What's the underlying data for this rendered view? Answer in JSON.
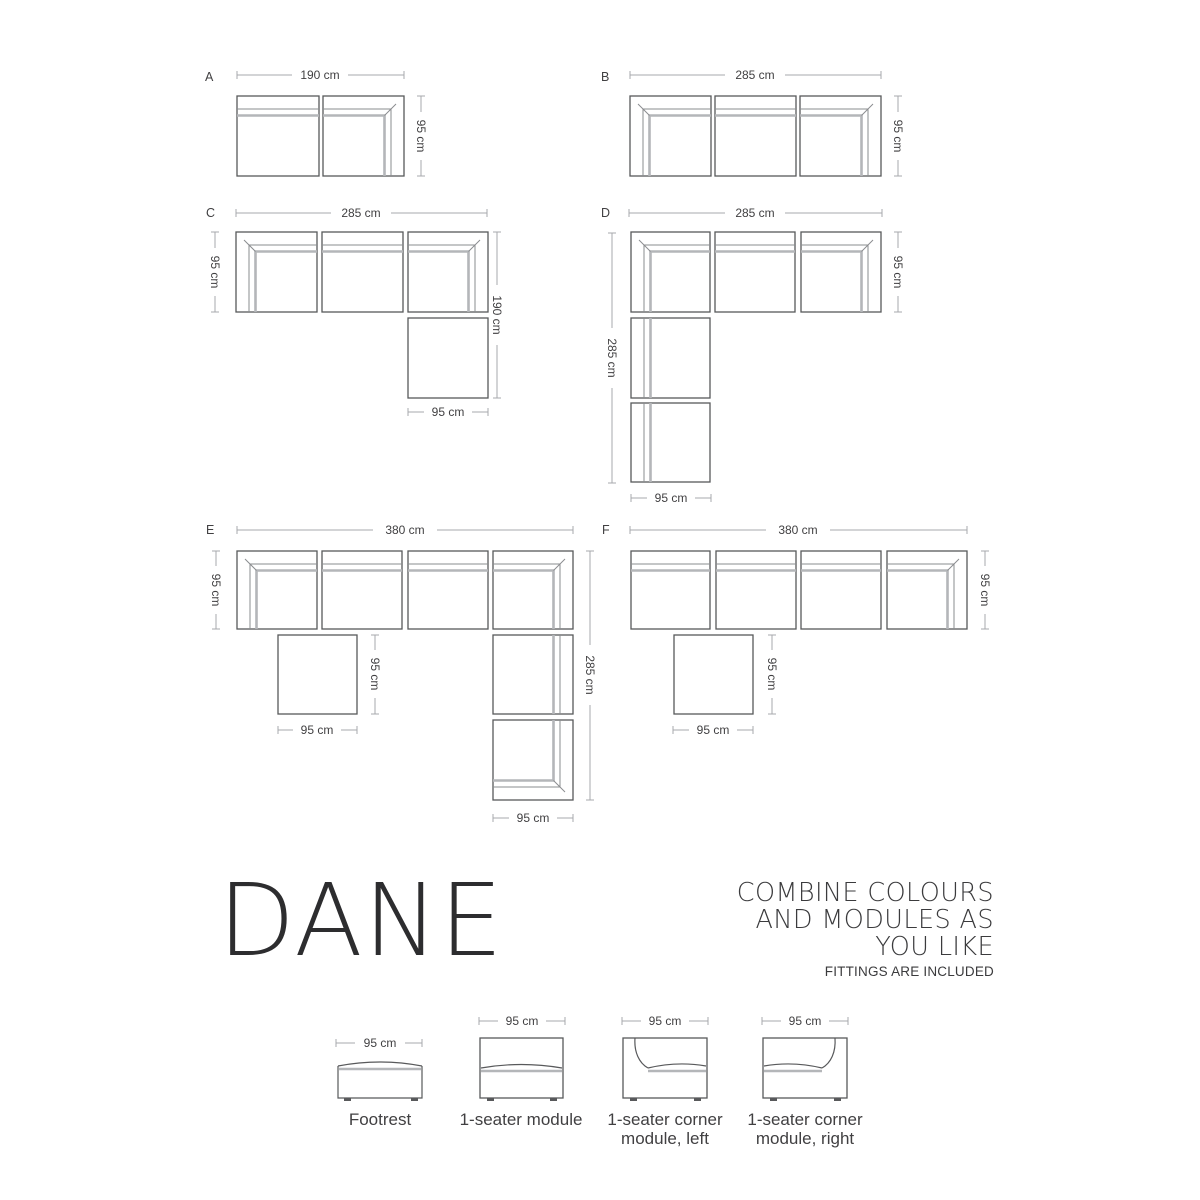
{
  "colors": {
    "module_outline": "#58595b",
    "inner_line": "#8a8c8f",
    "cushion_band": "#b4b6b9",
    "dimension_line": "#a7a9ac",
    "text": "#414042",
    "title": "#2d2d2f",
    "background": "#ffffff"
  },
  "configs": {
    "A": {
      "label": "A",
      "dims": {
        "top": "190 cm",
        "right": "95 cm"
      }
    },
    "B": {
      "label": "B",
      "dims": {
        "top": "285 cm",
        "right": "95 cm"
      }
    },
    "C": {
      "label": "C",
      "dims": {
        "top": "285 cm",
        "left": "95 cm",
        "right": "190 cm",
        "bottom": "95 cm"
      }
    },
    "D": {
      "label": "D",
      "dims": {
        "top": "285 cm",
        "right": "95 cm",
        "left": "285 cm",
        "bottom": "95 cm"
      }
    },
    "E": {
      "label": "E",
      "dims": {
        "top": "380 cm",
        "left": "95 cm",
        "right": "285 cm",
        "bottom": "95 cm",
        "footrest_right": "95 cm",
        "footrest_bottom": "95 cm"
      }
    },
    "F": {
      "label": "F",
      "dims": {
        "top": "380 cm",
        "right": "95 cm",
        "footrest_right": "95 cm",
        "footrest_bottom": "95 cm"
      }
    }
  },
  "branding": {
    "title": "DANE",
    "tagline_lines": [
      "COMBINE COLOURS",
      "AND MODULES AS",
      "YOU LIKE"
    ],
    "note": "FITTINGS ARE INCLUDED"
  },
  "legend": {
    "items": [
      {
        "dim": "95 cm",
        "label_lines": [
          "Footrest"
        ]
      },
      {
        "dim": "95 cm",
        "label_lines": [
          "1-seater module"
        ]
      },
      {
        "dim": "95 cm",
        "label_lines": [
          "1-seater corner",
          "module, left"
        ]
      },
      {
        "dim": "95 cm",
        "label_lines": [
          "1-seater corner",
          "module, right"
        ]
      }
    ]
  }
}
